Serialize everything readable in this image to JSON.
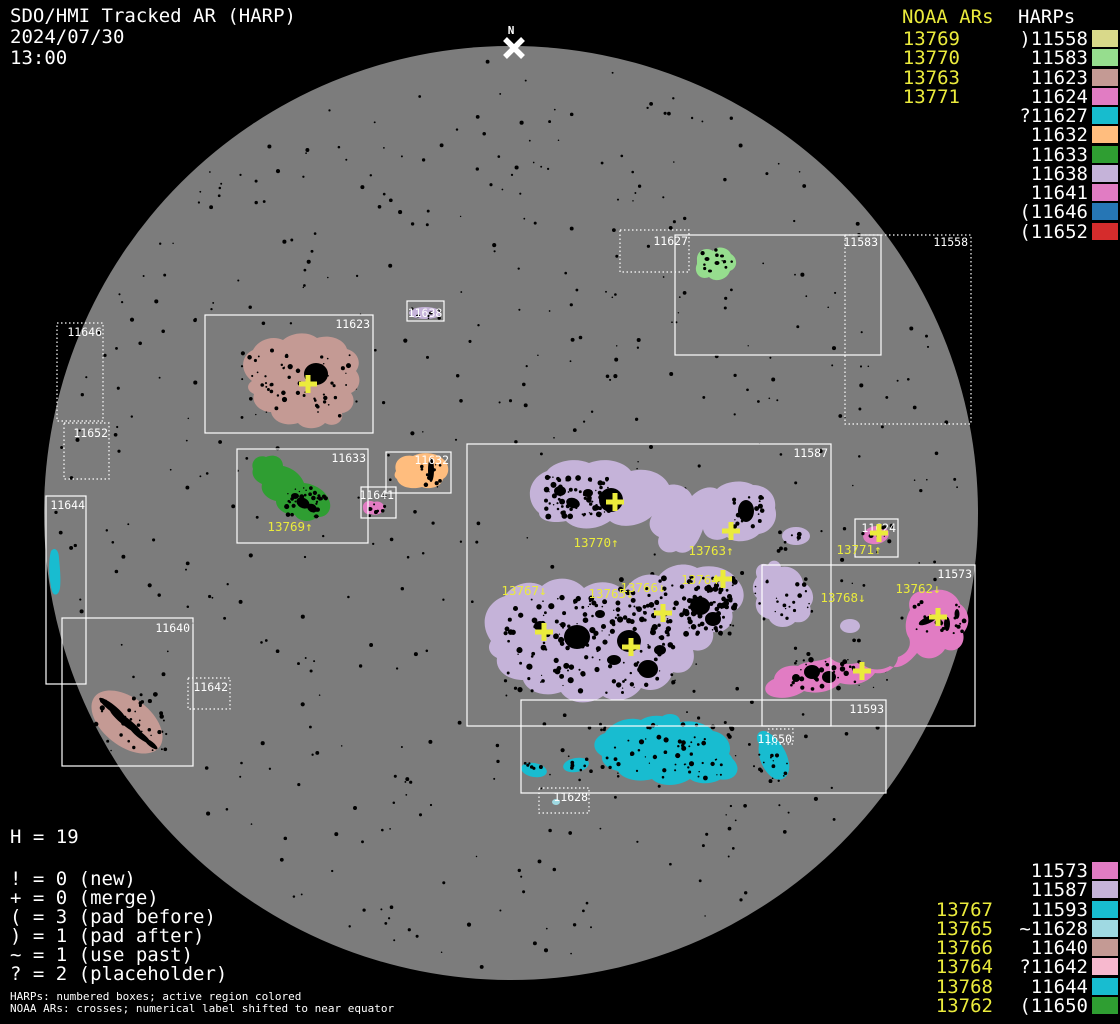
{
  "header": {
    "title": "SDO/HMI Tracked AR (HARP)",
    "date": "2024/07/30",
    "time": "13:00"
  },
  "north_marker": "N",
  "colors": {
    "background": "#000000",
    "disk_gray": "#7c7c7c",
    "accent_yellow": "#ebeb3c",
    "text_white": "#ffffff"
  },
  "legend_top_right": {
    "noaa_header": "NOAA ARs",
    "harps_header": "HARPs",
    "rows": [
      {
        "noaa": "13769",
        "harp": ")11558",
        "color": "#d9d98a"
      },
      {
        "noaa": "13770",
        "harp": "11583",
        "color": "#96dd8e"
      },
      {
        "noaa": "13763",
        "harp": "11623",
        "color": "#c49a94"
      },
      {
        "noaa": "13771",
        "harp": "11624",
        "color": "#e17cc3"
      },
      {
        "noaa": "",
        "harp": "?11627",
        "color": "#17bcce"
      },
      {
        "noaa": "",
        "harp": "11632",
        "color": "#ffbd7e"
      },
      {
        "noaa": "",
        "harp": "11633",
        "color": "#2f9e32"
      },
      {
        "noaa": "",
        "harp": "11638",
        "color": "#c5b3d9"
      },
      {
        "noaa": "",
        "harp": "11641",
        "color": "#e17cc3"
      },
      {
        "noaa": "",
        "harp": "(11646",
        "color": "#2676b5"
      },
      {
        "noaa": "",
        "harp": "(11652",
        "color": "#d52c2c"
      }
    ]
  },
  "legend_bottom_right": {
    "rows": [
      {
        "noaa": "",
        "harp": "11573",
        "color": "#e17cc3"
      },
      {
        "noaa": "",
        "harp": "11587",
        "color": "#c5b3d9"
      },
      {
        "noaa": "13767",
        "harp": "11593",
        "color": "#18bcd0"
      },
      {
        "noaa": "13765",
        "harp": "~11628",
        "color": "#9fd9e2"
      },
      {
        "noaa": "13766",
        "harp": "11640",
        "color": "#c49a94"
      },
      {
        "noaa": "13764",
        "harp": "?11642",
        "color": "#f7b8ce"
      },
      {
        "noaa": "13768",
        "harp": "11644",
        "color": "#18bcd0"
      },
      {
        "noaa": "13762",
        "harp": "(11650",
        "color": "#2f9e32"
      }
    ]
  },
  "stats": {
    "h_line": "H = 19",
    "lines": [
      "! = 0 (new)",
      "+ = 0 (merge)",
      "( = 3 (pad before)",
      ") = 1 (pad after)",
      "~ = 1 (use past)",
      "? = 2 (placeholder)"
    ]
  },
  "footer": {
    "lines": [
      "HARPs: numbered boxes; active region colored",
      "NOAA ARs: crosses; numerical label shifted to near equator"
    ]
  },
  "chart_data": {
    "type": "map-overlay",
    "description": "Full solar disk map with HARP bounding boxes (white rectangles, dotted = padded/placeholder) and NOAA AR crosses (yellow), labels shifted toward equator",
    "disk": {
      "cx": 511,
      "cy": 513,
      "r": 467
    },
    "harp_boxes": [
      {
        "id": "11558",
        "x1": 845,
        "y1": 235,
        "x2": 971,
        "y2": 424,
        "style": "dotted",
        "label_x": 968,
        "label_y": 246
      },
      {
        "id": "11627",
        "x1": 620,
        "y1": 230,
        "x2": 689,
        "y2": 272,
        "style": "dotted",
        "label_x": 688,
        "label_y": 245
      },
      {
        "id": "11583",
        "x1": 675,
        "y1": 235,
        "x2": 881,
        "y2": 355,
        "style": "solid",
        "label_x": 878,
        "label_y": 246
      },
      {
        "id": "11623",
        "x1": 205,
        "y1": 315,
        "x2": 373,
        "y2": 433,
        "style": "solid",
        "label_x": 370,
        "label_y": 328
      },
      {
        "id": "11638",
        "x1": 407,
        "y1": 301,
        "x2": 444,
        "y2": 321,
        "style": "solid",
        "label_x": 425,
        "label_y": 317,
        "label_anchor": "middle"
      },
      {
        "id": "11646",
        "x1": 57,
        "y1": 323,
        "x2": 103,
        "y2": 421,
        "style": "dotted",
        "label_x": 102,
        "label_y": 336
      },
      {
        "id": "11652",
        "x1": 64,
        "y1": 423,
        "x2": 109,
        "y2": 479,
        "style": "dotted",
        "label_x": 108,
        "label_y": 437
      },
      {
        "id": "11633",
        "x1": 237,
        "y1": 449,
        "x2": 368,
        "y2": 543,
        "style": "solid",
        "label_x": 366,
        "label_y": 462
      },
      {
        "id": "11632",
        "x1": 386,
        "y1": 452,
        "x2": 451,
        "y2": 493,
        "style": "solid",
        "label_x": 449,
        "label_y": 464
      },
      {
        "id": "11641",
        "x1": 361,
        "y1": 487,
        "x2": 396,
        "y2": 518,
        "style": "solid",
        "label_x": 394,
        "label_y": 499
      },
      {
        "id": "11644",
        "x1": 46,
        "y1": 496,
        "x2": 86,
        "y2": 684,
        "style": "solid",
        "label_x": 85,
        "label_y": 509
      },
      {
        "id": "11640",
        "x1": 62,
        "y1": 618,
        "x2": 193,
        "y2": 766,
        "style": "solid",
        "label_x": 190,
        "label_y": 632
      },
      {
        "id": "11642",
        "x1": 188,
        "y1": 678,
        "x2": 230,
        "y2": 709,
        "style": "dotted",
        "label_x": 228,
        "label_y": 691
      },
      {
        "id": "11587",
        "x1": 467,
        "y1": 444,
        "x2": 831,
        "y2": 726,
        "style": "solid",
        "label_x": 828,
        "label_y": 457
      },
      {
        "id": "11624",
        "x1": 855,
        "y1": 519,
        "x2": 898,
        "y2": 557,
        "style": "solid",
        "label_x": 896,
        "label_y": 532
      },
      {
        "id": "11573",
        "x1": 762,
        "y1": 565,
        "x2": 975,
        "y2": 726,
        "style": "solid",
        "label_x": 972,
        "label_y": 578
      },
      {
        "id": "11593",
        "x1": 521,
        "y1": 700,
        "x2": 886,
        "y2": 793,
        "style": "solid",
        "label_x": 884,
        "label_y": 713
      },
      {
        "id": "11628",
        "x1": 539,
        "y1": 788,
        "x2": 589,
        "y2": 813,
        "style": "dotted",
        "label_x": 588,
        "label_y": 801
      },
      {
        "id": "11650",
        "x1": 768,
        "y1": 729,
        "x2": 793,
        "y2": 744,
        "style": "dotted",
        "label_x": 792,
        "label_y": 743
      }
    ],
    "noaa_crosses": [
      {
        "id": "13769",
        "label": "13769↑",
        "cross_x": 308,
        "cross_y": 384,
        "label_x": 290,
        "label_y": 531
      },
      {
        "id": "13770",
        "label": "13770↑",
        "cross_x": 615,
        "cross_y": 502,
        "label_x": 596,
        "label_y": 547
      },
      {
        "id": "13763",
        "label": "13763↑",
        "cross_x": 731,
        "cross_y": 531,
        "label_x": 711,
        "label_y": 555
      },
      {
        "id": "13771",
        "label": "13771↑",
        "cross_x": 879,
        "cross_y": 533,
        "label_x": 859,
        "label_y": 554
      },
      {
        "id": "13764",
        "label": "13764",
        "cross_x": 723,
        "cross_y": 579,
        "label_x": 700,
        "label_y": 584
      },
      {
        "id": "13767",
        "label": "13767↓",
        "cross_x": 544,
        "cross_y": 632,
        "label_x": 524,
        "label_y": 595
      },
      {
        "id": "13765",
        "label": "13765↓",
        "cross_x": 631,
        "cross_y": 647,
        "label_x": 611,
        "label_y": 598
      },
      {
        "id": "13766",
        "label": "13766↓",
        "cross_x": 663,
        "cross_y": 613,
        "label_x": 643,
        "label_y": 592
      },
      {
        "id": "13768",
        "label": "13768↓",
        "cross_x": 862,
        "cross_y": 671,
        "label_x": 843,
        "label_y": 602
      },
      {
        "id": "13762",
        "label": "13762↓",
        "cross_x": 938,
        "cross_y": 617,
        "label_x": 918,
        "label_y": 593
      }
    ]
  }
}
